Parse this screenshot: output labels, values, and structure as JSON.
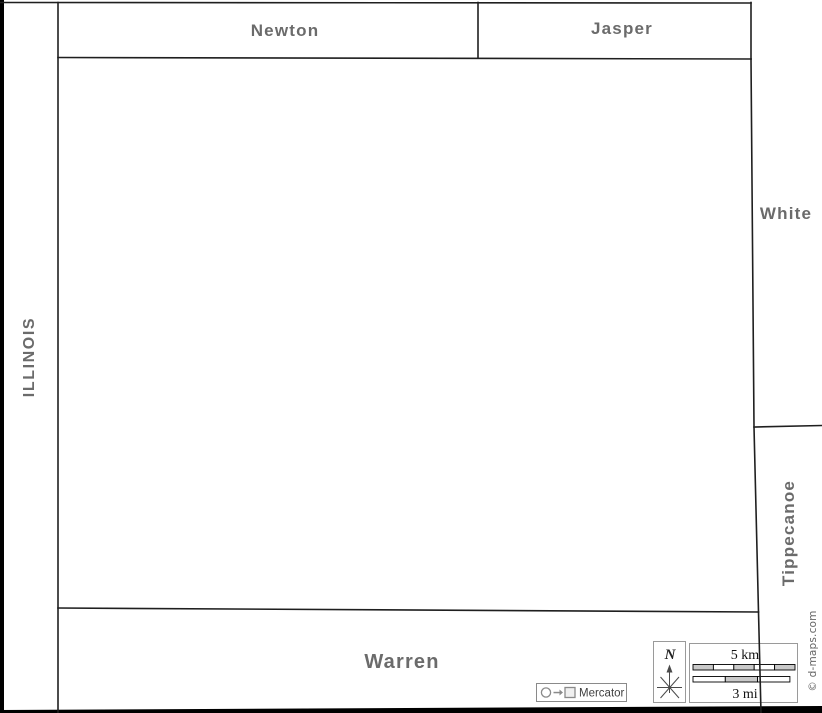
{
  "map": {
    "region_labels": {
      "newton": "Newton",
      "jasper": "Jasper",
      "white": "White",
      "tippecanoe": "Tippecanoe",
      "warren": "Warren",
      "illinois": "ILLINOIS"
    }
  },
  "legend": {
    "north_label": "N",
    "scale_km": "5 km",
    "scale_mi": "3 mi",
    "projection": "Mercator",
    "credit": "© d-maps.com"
  },
  "colors": {
    "region_label": "#6b6b6b",
    "border_line": "#1f1f1f",
    "edge_bar": "#000000",
    "box_border": "#9a9a9a",
    "scale_bar_fill": "#c9c9c9",
    "icon_gray": "#8a8a8a"
  }
}
